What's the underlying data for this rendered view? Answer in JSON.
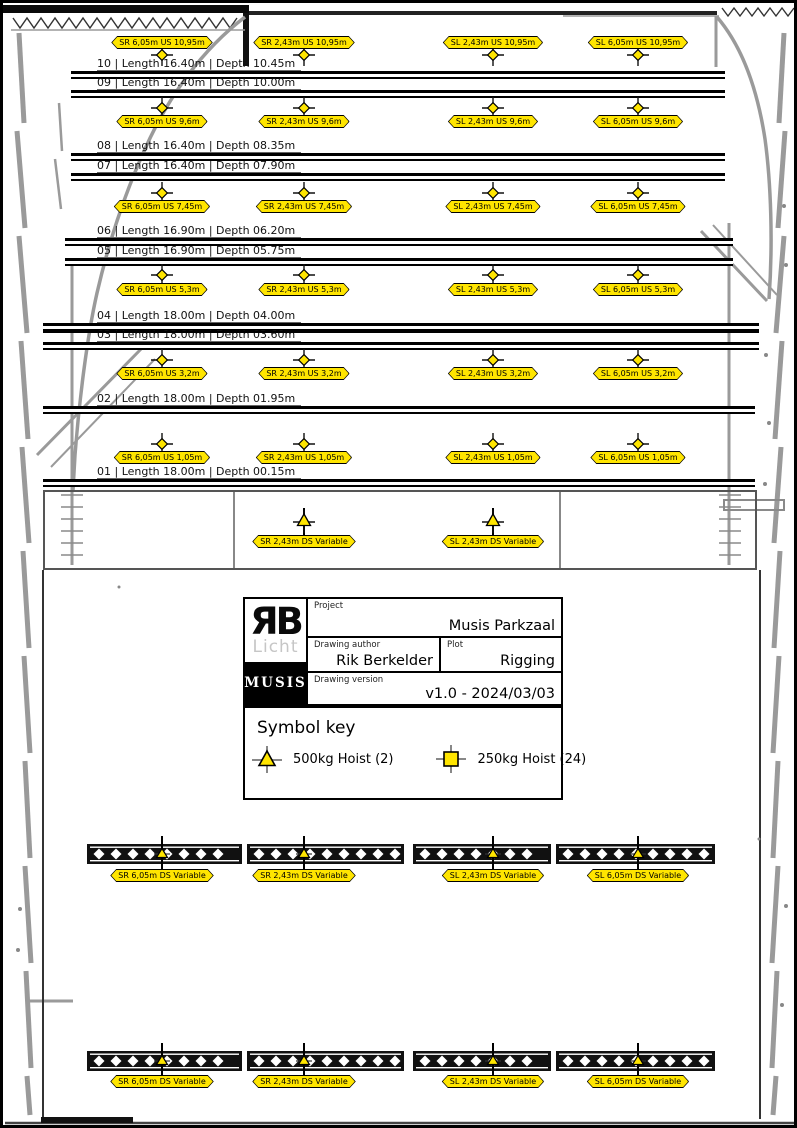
{
  "title_block": {
    "logo_rb": "ЯB",
    "logo_licht": "Licht",
    "logo_musis": "MUSIS",
    "project_label": "Project",
    "project_value": "Musis Parkzaal",
    "author_label": "Drawing author",
    "author_value": "Rik Berkelder",
    "plot_label": "Plot",
    "plot_value": "Rigging",
    "version_label": "Drawing version",
    "version_value": "v1.0 - 2024/03/03"
  },
  "symbol_key": {
    "title": "Symbol key",
    "items": [
      {
        "icon": "500kg-hoist-icon",
        "label": "500kg Hoist (2)"
      },
      {
        "icon": "250kg-hoist-icon",
        "label": "250kg Hoist (24)"
      }
    ]
  },
  "colors": {
    "hoist_yellow": "#FFE500",
    "line_black": "#000000",
    "wall_gray": "#9a9a9a"
  },
  "plot": {
    "columns": [
      159,
      301,
      490,
      635
    ],
    "battens": [
      {
        "id": "10",
        "text": "10 | Length 16.40m | Depth 10.45m",
        "y": 68,
        "x1": 68,
        "x2": 722
      },
      {
        "id": "09",
        "text": "09 | Length 16.40m | Depth 10.00m",
        "y": 87,
        "x1": 68,
        "x2": 722
      },
      {
        "id": "08",
        "text": "08 | Length 16.40m | Depth 08.35m",
        "y": 150,
        "x1": 68,
        "x2": 722
      },
      {
        "id": "07",
        "text": "07 | Length 16.40m | Depth 07.90m",
        "y": 170,
        "x1": 68,
        "x2": 722
      },
      {
        "id": "06",
        "text": "06 | Length 16.90m | Depth 06.20m",
        "y": 235,
        "x1": 62,
        "x2": 730
      },
      {
        "id": "05",
        "text": "05 | Length 16.90m | Depth 05.75m",
        "y": 255,
        "x1": 62,
        "x2": 730
      },
      {
        "id": "04",
        "text": "04 | Length 18.00m | Depth 04.00m",
        "y": 320,
        "x1": 40,
        "x2": 756
      },
      {
        "id": "03",
        "text": "03 | Length 18.00m | Depth 03.60m",
        "y": 339,
        "x1": 40,
        "x2": 756
      },
      {
        "id": "02",
        "text": "02 | Length 18.00m | Depth 01.95m",
        "y": 403,
        "x1": 40,
        "x2": 752
      },
      {
        "id": "01",
        "text": "01 | Length 18.00m | Depth 00.15m",
        "y": 476,
        "x1": 40,
        "x2": 752
      }
    ],
    "stray_line": {
      "y": 328,
      "x1": 40,
      "x2": 756
    },
    "stage_rows": [
      {
        "us": "10,95m",
        "label_above": true,
        "hoist_y": 52,
        "label_y": 33,
        "labels": [
          "SR 6,05m US 10,95m",
          "SR 2,43m US 10,95m",
          "SL 2,43m US 10,95m",
          "SL 6,05m US 10,95m"
        ]
      },
      {
        "us": "9,6m",
        "label_above": false,
        "hoist_y": 105,
        "label_y": 112,
        "labels": [
          "SR 6,05m US 9,6m",
          "SR 2,43m US 9,6m",
          "SL 2,43m US 9,6m",
          "SL 6,05m US 9,6m"
        ]
      },
      {
        "us": "7,45m",
        "label_above": false,
        "hoist_y": 190,
        "label_y": 197,
        "labels": [
          "SR 6,05m US 7,45m",
          "SR 2,43m US 7,45m",
          "SL 2,43m US 7,45m",
          "SL 6,05m US 7,45m"
        ]
      },
      {
        "us": "5,3m",
        "label_above": false,
        "hoist_y": 272,
        "label_y": 280,
        "labels": [
          "SR 6,05m US 5,3m",
          "SR 2,43m US 5,3m",
          "SL 2,43m US 5,3m",
          "SL 6,05m US 5,3m"
        ]
      },
      {
        "us": "3,2m",
        "label_above": false,
        "hoist_y": 357,
        "label_y": 364,
        "labels": [
          "SR 6,05m US 3,2m",
          "SR 2,43m US 3,2m",
          "SL 2,43m US 3,2m",
          "SL 6,05m US 3,2m"
        ]
      },
      {
        "us": "1,05m",
        "label_above": false,
        "hoist_y": 441,
        "label_y": 448,
        "labels": [
          "SR 6,05m US 1,05m",
          "SR 2,43m US 1,05m",
          "SL 2,43m US 1,05m",
          "SL 6,05m US 1,05m"
        ]
      }
    ],
    "apron": {
      "box": {
        "x": 40,
        "y": 487,
        "w": 714,
        "h": 80
      },
      "dividers": [
        230,
        556
      ],
      "hoist_y": 518,
      "label_y": 532,
      "hoists": [
        {
          "x": 301,
          "label": "SR 2,43m DS Variable"
        },
        {
          "x": 490,
          "label": "SL 2,43m DS Variable"
        }
      ]
    },
    "ds_truss_rows": [
      {
        "truss_y": 841,
        "truss_h": 20,
        "label_y": 866,
        "sections": [
          [
            84,
            239
          ],
          [
            244,
            401
          ],
          [
            410,
            548
          ],
          [
            553,
            712
          ]
        ],
        "hoists": [
          {
            "x": 159,
            "label": "SR 6,05m DS Variable"
          },
          {
            "x": 301,
            "label": "SR 2,43m DS Variable"
          },
          {
            "x": 490,
            "label": "SL 2,43m DS Variable"
          },
          {
            "x": 635,
            "label": "SL 6,05m DS Variable"
          }
        ]
      },
      {
        "truss_y": 1048,
        "truss_h": 20,
        "label_y": 1072,
        "sections": [
          [
            84,
            239
          ],
          [
            244,
            401
          ],
          [
            410,
            548
          ],
          [
            553,
            712
          ]
        ],
        "hoists": [
          {
            "x": 159,
            "label": "SR 6,05m DS Variable"
          },
          {
            "x": 301,
            "label": "SR 2,43m DS Variable"
          },
          {
            "x": 490,
            "label": "SL 2,43m DS Variable"
          },
          {
            "x": 635,
            "label": "SL 6,05m DS Variable"
          }
        ]
      }
    ]
  }
}
